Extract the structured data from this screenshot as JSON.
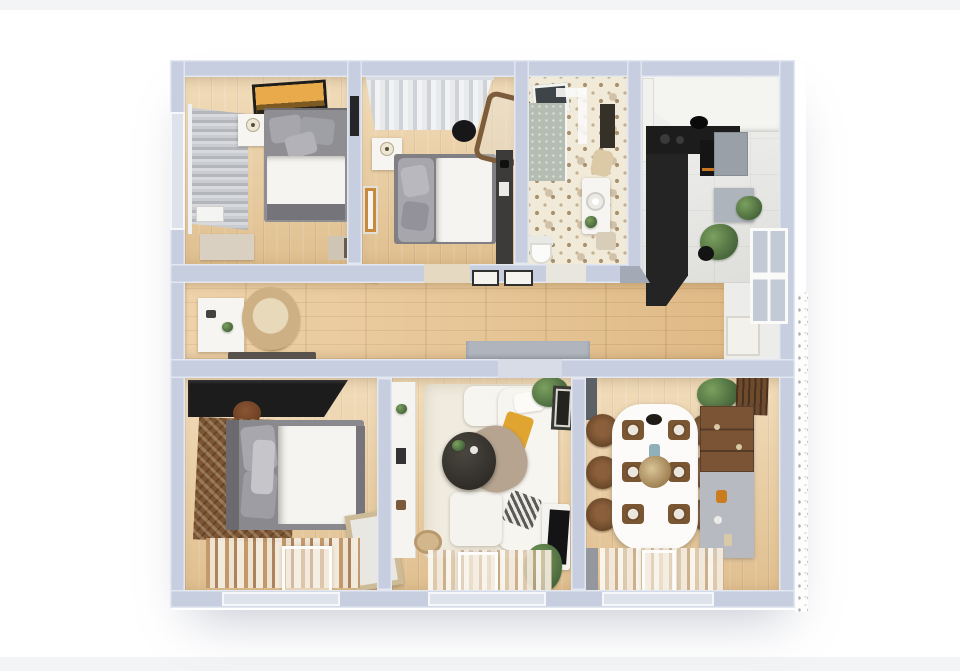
{
  "scene": {
    "type": "3d-floor-plan-top-down-render",
    "visible_text": "none",
    "rooms": [
      {
        "id": "bedroom-top-left",
        "furniture": [
          "window-blinds",
          "curtain-rod",
          "radiator",
          "wall-art-orange",
          "nightstand",
          "table-lamp",
          "double-bed",
          "wall-tv",
          "dresser",
          "bench"
        ]
      },
      {
        "id": "bedroom-top-middle",
        "furniture": [
          "sheer-curtains",
          "curtain-rod",
          "nightstand",
          "table-lamp",
          "wall-frame",
          "double-bed",
          "black-pouf",
          "leaning-mirror",
          "wall-desk"
        ]
      },
      {
        "id": "bathroom",
        "furniture": [
          "skylight",
          "walk-in-shower",
          "glass-ledge",
          "towel-rail",
          "vanity-sink",
          "plant",
          "toilet",
          "towel",
          "stool"
        ]
      },
      {
        "id": "kitchen",
        "furniture": [
          "upper-cabinets",
          "tall-cabinet",
          "black-l-counter",
          "cooking-pot",
          "oven",
          "refrigerator",
          "work-table",
          "counter-plant",
          "floor-plant",
          "window",
          "radiator"
        ]
      },
      {
        "id": "hallway",
        "furniture": [
          "white-sideboard",
          "round-jute-rug",
          "dark-runner",
          "two-wall-frames",
          "gray-doormat",
          "open-door-leaf",
          "window",
          "radiator"
        ]
      },
      {
        "id": "bedroom-bottom-left",
        "furniture": [
          "black-wardrobe",
          "round-pouf",
          "round-pouf",
          "patterned-brown-rug",
          "double-bed",
          "leaning-mirror",
          "striped-rug",
          "floor-window"
        ]
      },
      {
        "id": "living-room",
        "furniture": [
          "wall-shelving",
          "cream-area-rug",
          "corner-sofa",
          "yellow-cushion",
          "taupe-throw",
          "striped-cushion",
          "round-coffee-table",
          "wall-frame",
          "tv-console",
          "tv",
          "plant",
          "plant",
          "jute-pouf",
          "striped-rug",
          "floor-window"
        ]
      },
      {
        "id": "dining-room",
        "furniture": [
          "oval-dining-table",
          "six-dining-chairs",
          "six-place-settings",
          "center-bowl",
          "vase-centerpiece",
          "sideboard-wardrobe",
          "wood-slat-decor",
          "plant",
          "open-door-leaf",
          "striped-rug",
          "floor-window"
        ]
      }
    ]
  },
  "palette": {
    "bg": "#ffffff",
    "band": "#f3f4f6",
    "wall": "#c6cedf",
    "woodA": "#eccfa0",
    "hallA": "#eac794",
    "tile": "#e6e6e4",
    "bathBg": "#f1ead9",
    "bathDot": "#a8906d",
    "black": "#1c1c1c",
    "dark": "#3c3b3a",
    "white": "#f6f5f2",
    "bedBase": "#8f8e93",
    "pillow": "#a7a6ac",
    "duvet": "#f5f4f1",
    "rugCream": "#f0ebdf",
    "rugBrown": "#7c5634",
    "poufBrown": "#7b4a2c",
    "jute": "#d2b68c",
    "yellow": "#e0a430",
    "green": "#7ba05e",
    "greenDeep": "#47663b",
    "woodFurn": "#7b5436",
    "chair": "#6f4b2c",
    "sofa": "#f7f5f0",
    "taupe": "#b6a491",
    "matGray": "#b0b5bd",
    "appliance": "#9aa0a7",
    "speckle": "#a9aeb6",
    "artOrange": "#e8aa4a",
    "glass": "#c2cbd5"
  }
}
